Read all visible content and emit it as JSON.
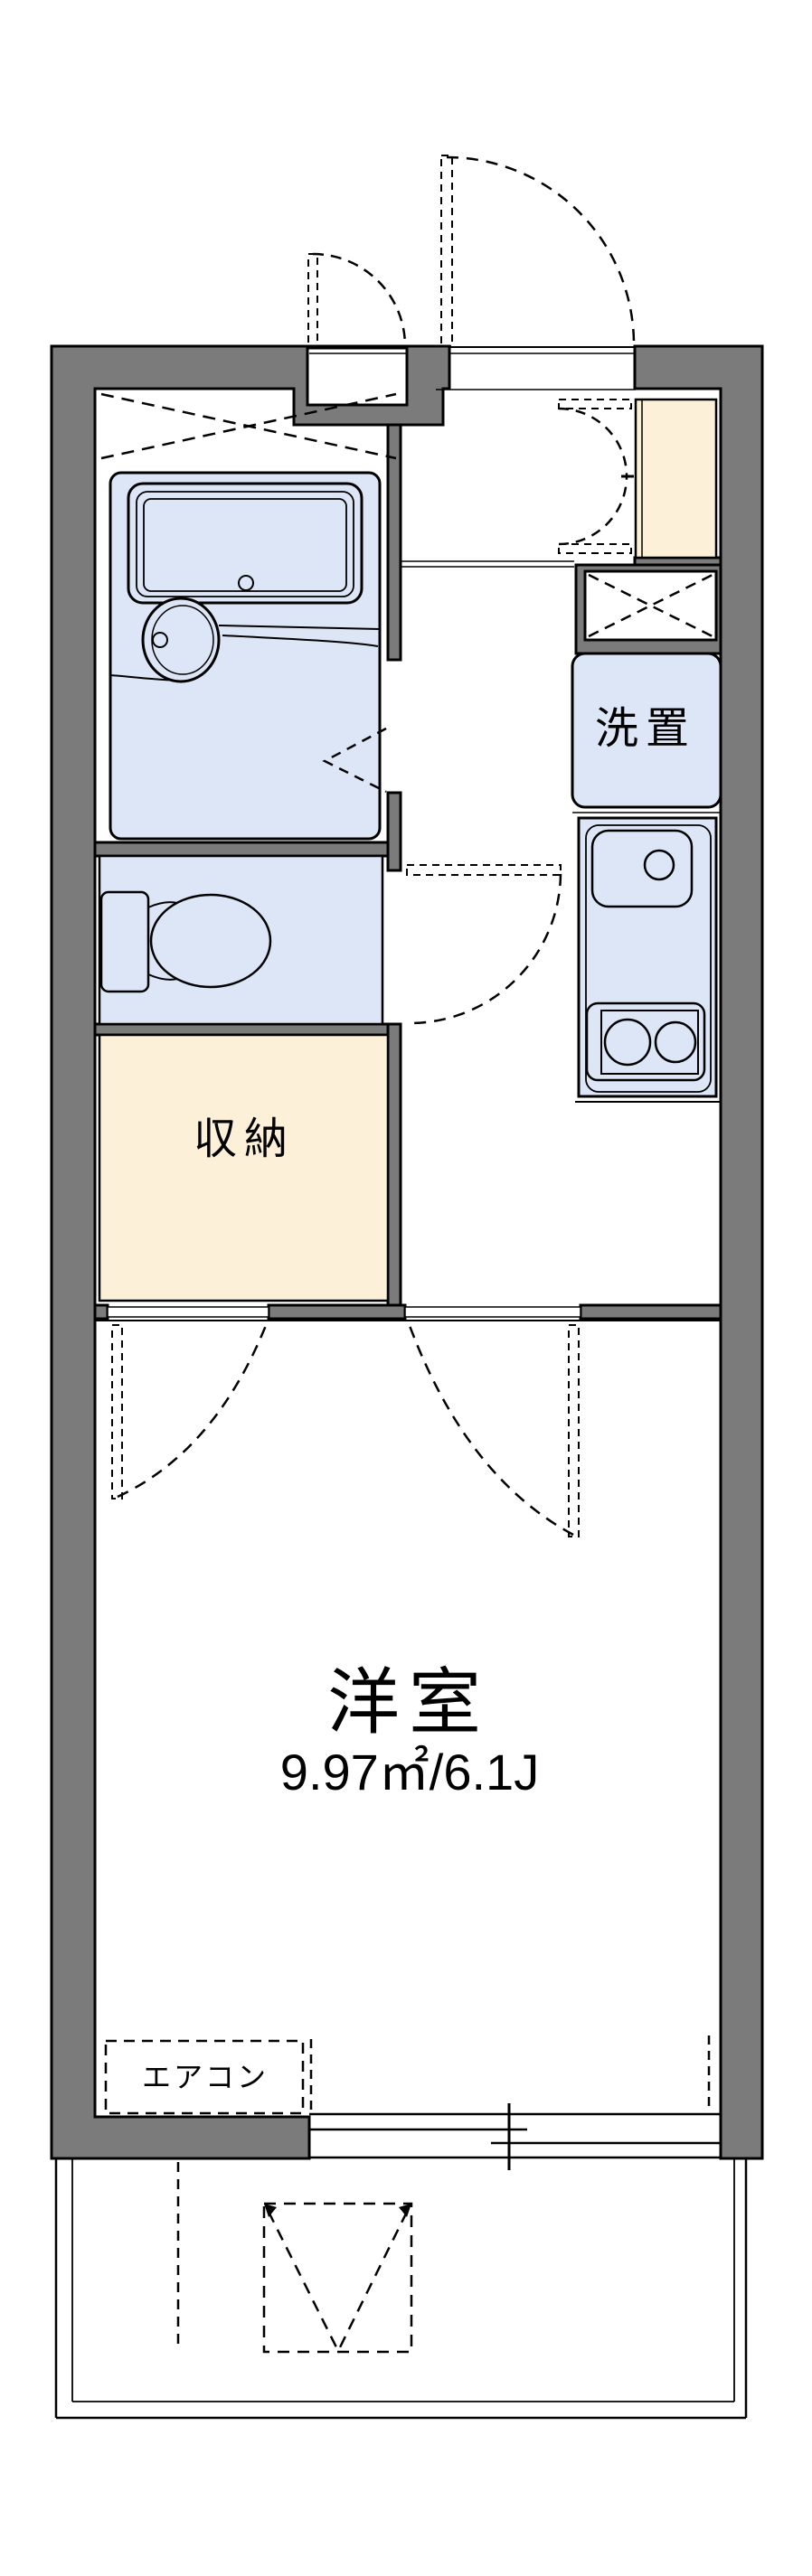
{
  "floorplan": {
    "rooms": {
      "washer_label": "洗置",
      "storage_label": "収納",
      "main_room_label": "洋室",
      "main_room_size": "9.97㎡/6.1J",
      "aircon_label": "エアコン"
    },
    "colors": {
      "wall": "#7b7b7b",
      "water_fixture_fill": "#dce6f7",
      "storage_fill": "#fcf0d8",
      "line": "#000000",
      "background": "#ffffff"
    }
  }
}
